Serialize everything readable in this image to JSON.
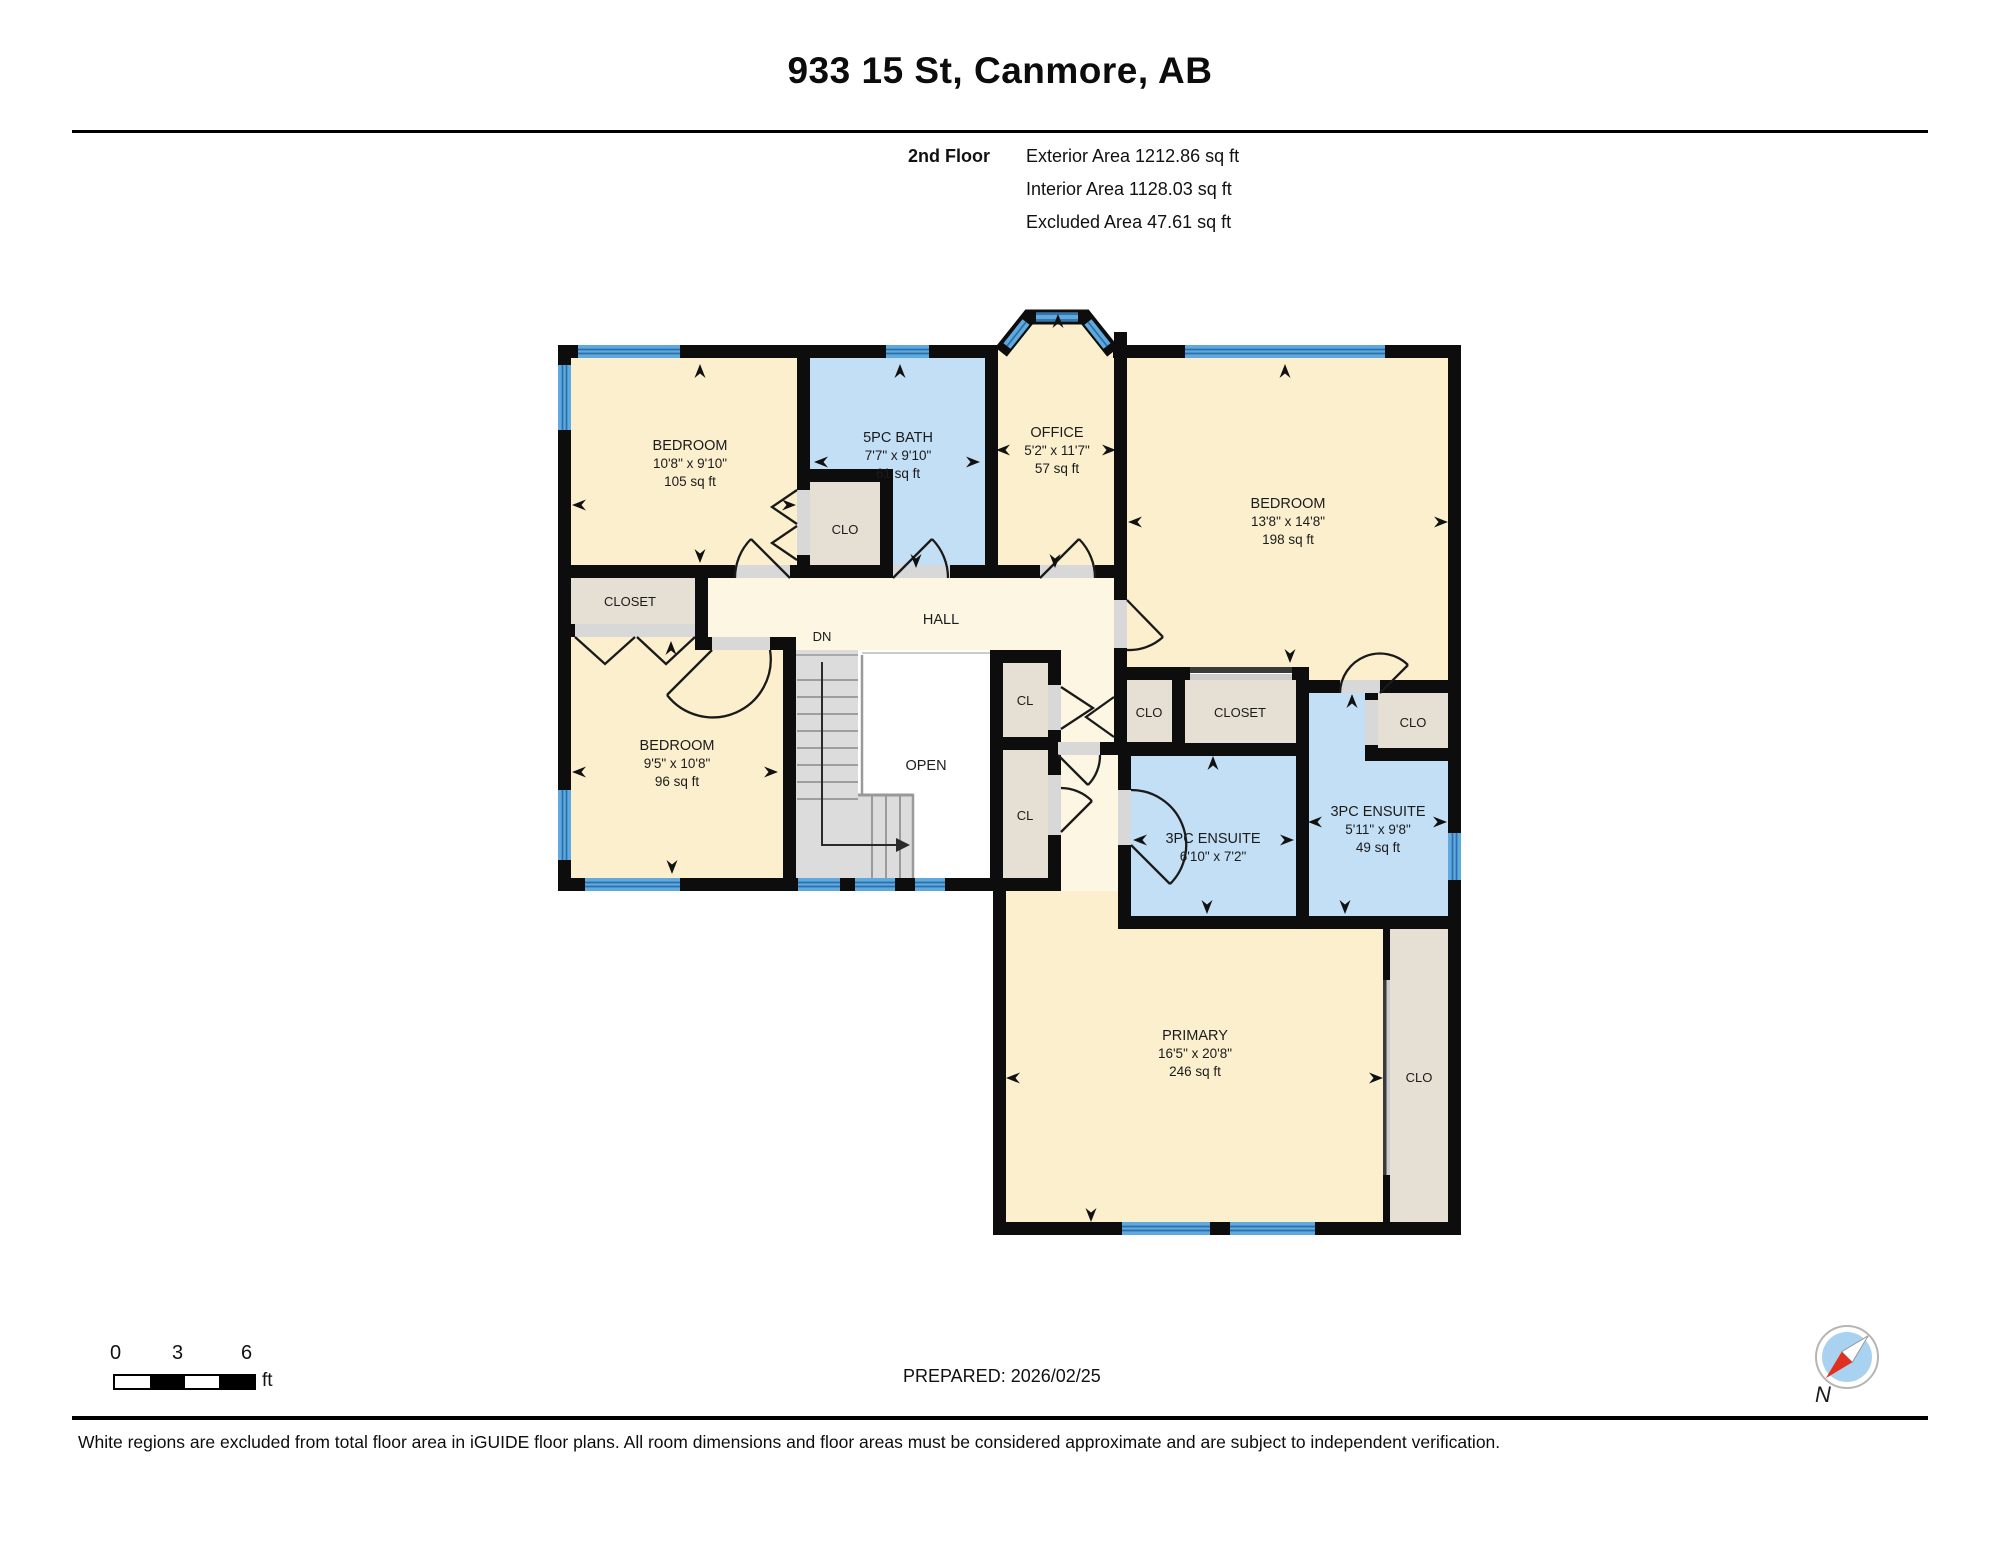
{
  "header": {
    "title": "933 15 St, Canmore, AB",
    "floor_label": "2nd Floor",
    "exterior_area": "Exterior Area 1212.86 sq ft",
    "interior_area": "Interior Area 1128.03 sq ft",
    "excluded_area": "Excluded Area 47.61 sq ft"
  },
  "plan": {
    "rooms": {
      "bedroom_top_left": {
        "name": "BEDROOM",
        "dims": "10'8\" x 9'10\"",
        "area": "105 sq ft"
      },
      "bath": {
        "name": "5PC BATH",
        "dims": "7'7\" x 9'10\"",
        "area": "61 sq ft"
      },
      "office": {
        "name": "OFFICE",
        "dims": "5'2\" x 11'7\"",
        "area": "57 sq ft"
      },
      "bedroom_top_right": {
        "name": "BEDROOM",
        "dims": "13'8\" x 14'8\"",
        "area": "198 sq ft"
      },
      "bedroom_mid_left": {
        "name": "BEDROOM",
        "dims": "9'5\" x 10'8\"",
        "area": "96 sq ft"
      },
      "ensuite_left": {
        "name": "3PC ENSUITE",
        "dims": "6'10\" x 7'2\""
      },
      "ensuite_right": {
        "name": "3PC ENSUITE",
        "dims": "5'11\" x 9'8\"",
        "area": "49 sq ft"
      },
      "primary": {
        "name": "PRIMARY",
        "dims": "16'5\" x 20'8\"",
        "area": "246 sq ft"
      }
    },
    "labels": {
      "hall": "HALL",
      "dn": "DN",
      "open": "OPEN",
      "closet_left": "CLOSET",
      "closet_mid": "CLOSET",
      "clo_bath": "CLO",
      "clo_mid": "CLO",
      "clo_right": "CLO",
      "clo_primary": "CLO",
      "cl_upper": "CL",
      "cl_lower": "CL"
    }
  },
  "footer": {
    "scale": {
      "tick0": "0",
      "tick3": "3",
      "tick6": "6",
      "unit": "ft"
    },
    "prepared": "PREPARED: 2026/02/25",
    "compass_north": "N",
    "disclaimer": "White regions are excluded from total floor area in iGUIDE floor plans. All room dimensions and floor areas must be considered approximate and are subject to independent verification."
  },
  "colors": {
    "wall": "#0d0d0d",
    "room_cream": "#fbefcd",
    "hall_pale": "#fcf6e2",
    "wet_blue": "#c3dff5",
    "closet_grey": "#e6dfd4",
    "stairs_grey": "#dcdcdc",
    "window_blue": "#5fa9de",
    "window_stripe": "#2b6fa9",
    "compass_red": "#e03020"
  }
}
